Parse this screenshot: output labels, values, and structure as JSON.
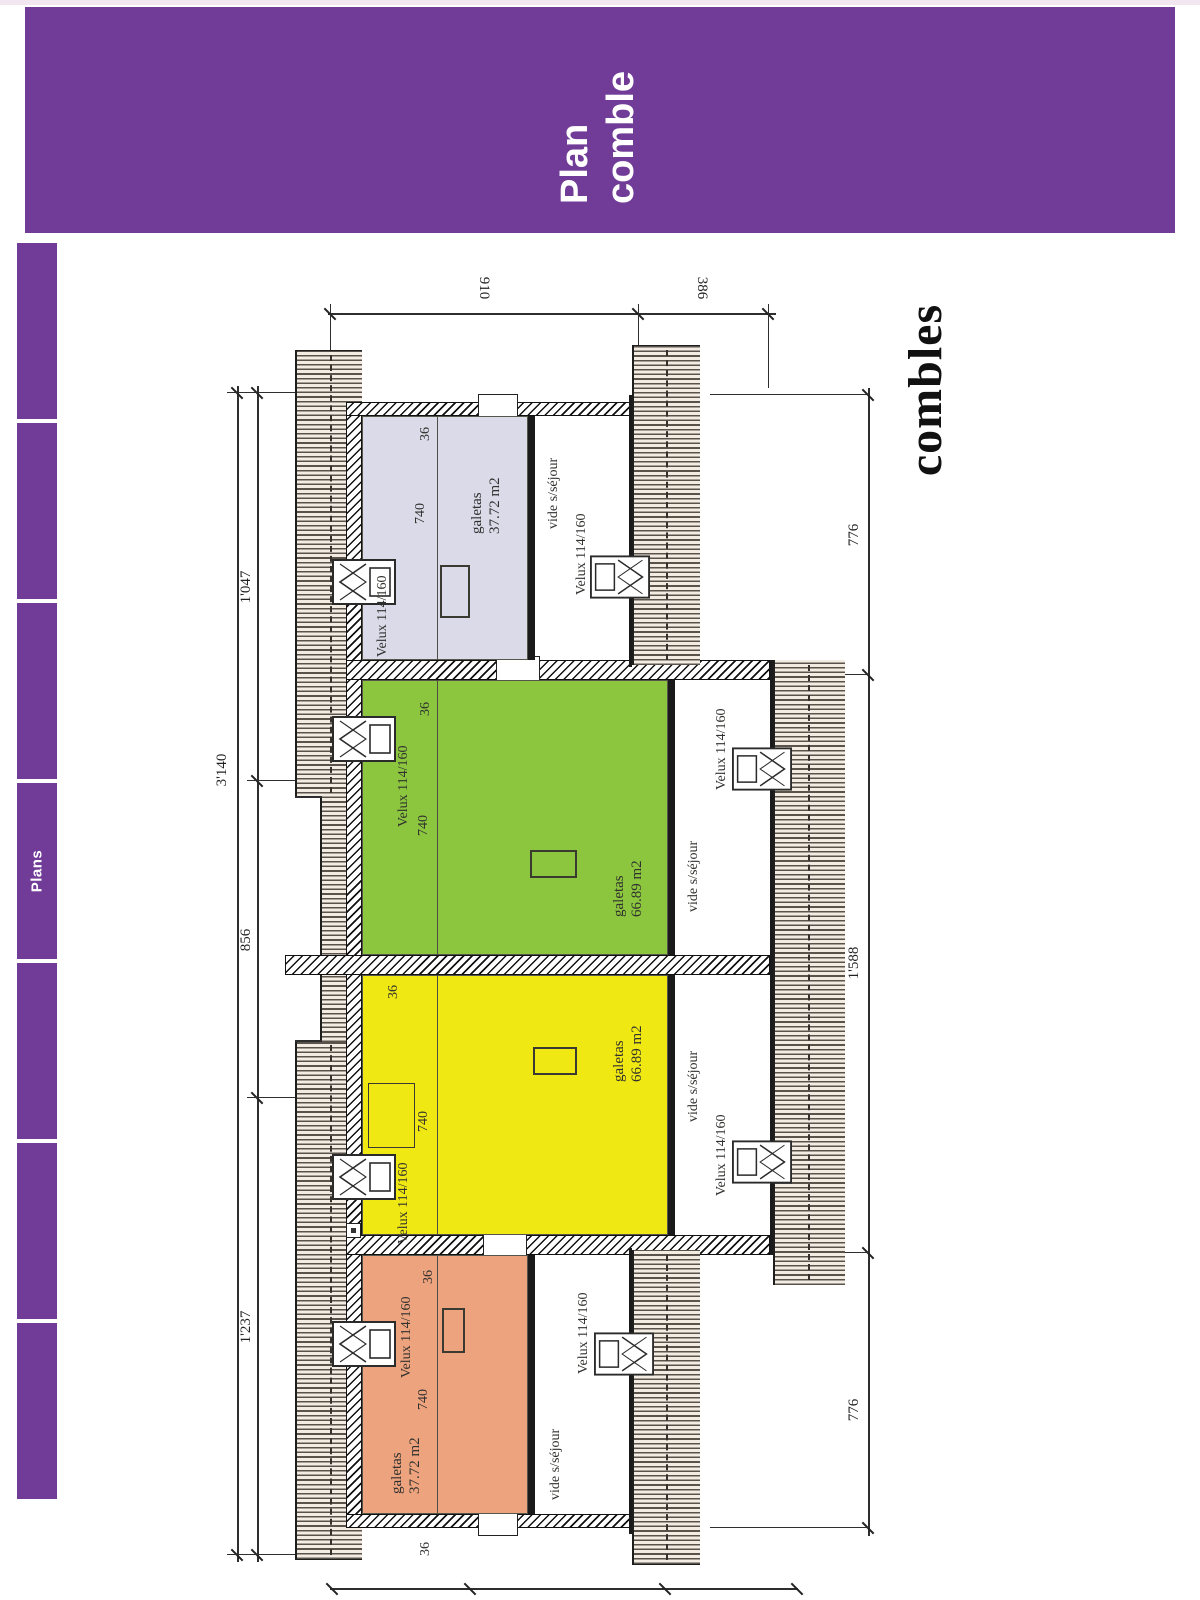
{
  "header": {
    "line1": "Plan",
    "line2": "comble",
    "background": "#713C97"
  },
  "sidebar": {
    "label": "Plans",
    "background": "#713C97",
    "segment_count": 7
  },
  "plan": {
    "caption": "combles",
    "dims": {
      "total": "3'140",
      "top": [
        "1'237",
        "856",
        "1'047"
      ],
      "bottom": [
        "776",
        "1'588",
        "776"
      ],
      "side": [
        "910",
        "386"
      ],
      "headroom": "740",
      "wall": "36"
    },
    "units": [
      {
        "id": "orange",
        "room": "galetas",
        "area": "37.72 m2",
        "velux": "Velux 114/160",
        "void": "vide s/séjour",
        "void_velux": "Velux 114/160",
        "color": "#EDA47E"
      },
      {
        "id": "yellow",
        "room": "galetas",
        "area": "66.89 m2",
        "velux": "Velux 114/160",
        "void": "vide s/séjour",
        "void_velux": "Velux 114/160",
        "color": "#F0E813"
      },
      {
        "id": "green",
        "room": "galetas",
        "area": "66.89 m2",
        "velux": "Velux 114/160",
        "void": "vide s/séjour",
        "void_velux": "Velux 114/160",
        "color": "#8CC63F"
      },
      {
        "id": "lavender",
        "room": "galetas",
        "area": "37.72 m2",
        "velux": "Velux 114/160",
        "void": "vide s/séjour",
        "void_velux": "Velux 114/160",
        "color": "#DADAE9"
      }
    ]
  }
}
